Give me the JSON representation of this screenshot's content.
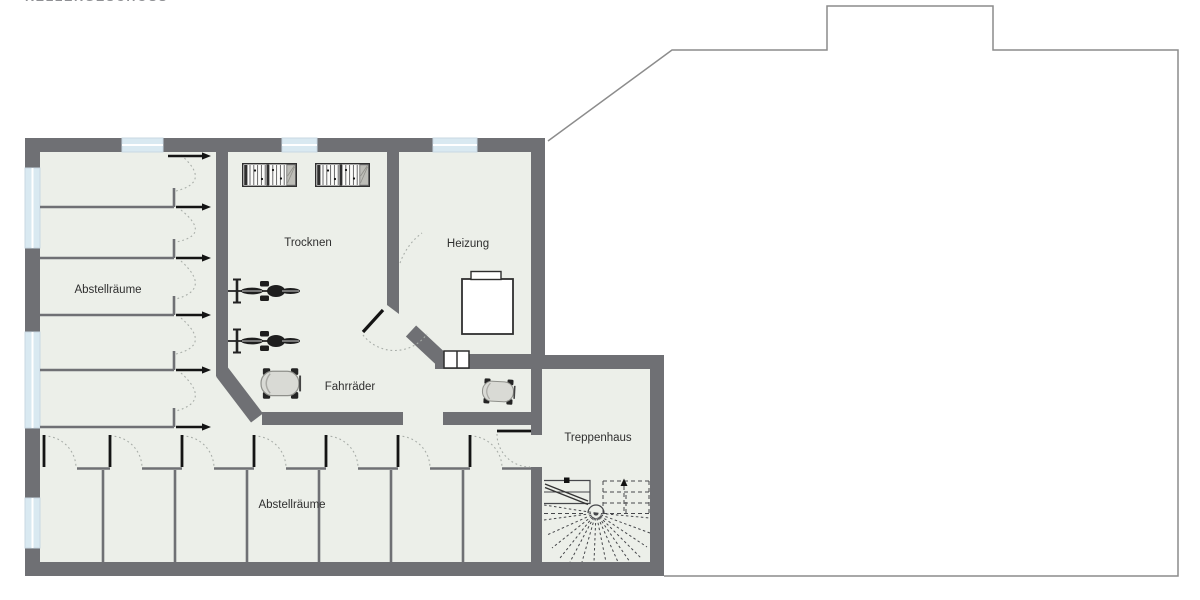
{
  "title": {
    "text": "KELLERGESCHOSS"
  },
  "rooms": {
    "abstellraeume_left": {
      "label": "Abstellräume"
    },
    "trocknen": {
      "label": "Trocknen"
    },
    "heizung": {
      "label": "Heizung"
    },
    "fahrraeder": {
      "label": "Fahrräder"
    },
    "abstellraeume_bottom": {
      "label": "Abstellräume"
    },
    "treppenhaus": {
      "label": "Treppenhaus"
    }
  },
  "icons": {
    "drying_racks": {
      "name": "drying-rack-icon",
      "count": 2
    },
    "bicycles": {
      "name": "bicycle-icon",
      "count": 2
    },
    "strollers": {
      "name": "stroller-icon",
      "count": 2
    },
    "boiler": {
      "name": "boiler-icon",
      "count": 1
    },
    "shaft": {
      "name": "chimney-shaft-icon",
      "count": 1
    },
    "staircase": {
      "name": "winder-staircase-icon",
      "count": 1
    }
  },
  "colors": {
    "wall": "#6F7074",
    "floor": "#ECEFE9",
    "window": "#D9E9F1",
    "door": "#141414",
    "swing_arc": "#A9AEA9",
    "upper_floor_outline": "#8C8C8C",
    "background": "#FFFFFF",
    "label_text": "#2F2F2F"
  }
}
